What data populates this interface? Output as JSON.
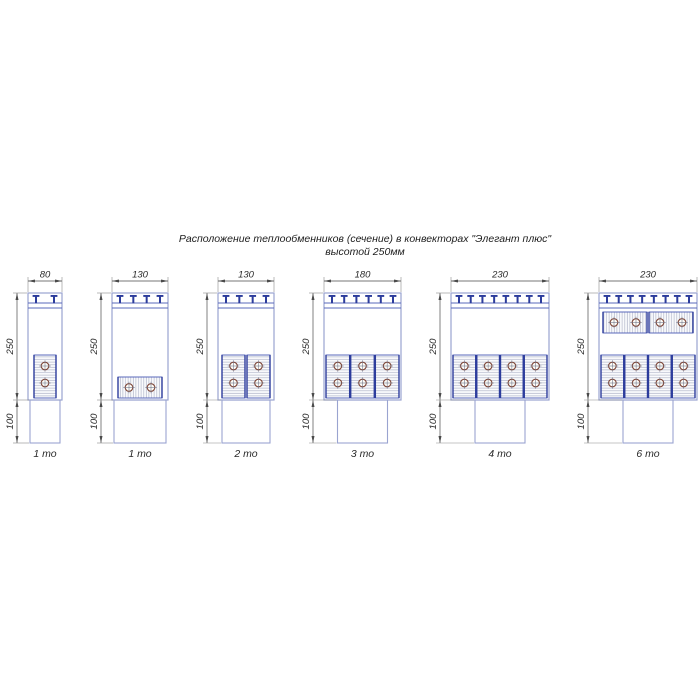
{
  "title": {
    "line1": "Расположение теплообменников (сечение) в конвекторах \"Элегант плюс\"",
    "line2": "высотой 250мм"
  },
  "colors": {
    "outline": "#9aa4d0",
    "line_blue": "#5a68bb",
    "dark_blue": "#2c3c9c",
    "hatch": "#b2b7ca",
    "tube": "#7e4739",
    "tube_cross": "#6b6f85",
    "dim": "#4a4a4a",
    "ext": "#8a8a8a",
    "label": "#1f1f1f"
  },
  "diagrams": [
    {
      "label": "1 то",
      "width_mm": 80,
      "width_label": "80",
      "height_label": "250",
      "base_label": "100",
      "duct_w": 30,
      "brackets": 2,
      "vertical": {
        "count": 1,
        "inset": 6,
        "gap": 2
      },
      "horizontal": null
    },
    {
      "label": "1 то",
      "width_mm": 130,
      "width_label": "130",
      "height_label": "250",
      "base_label": "100",
      "duct_w": 52,
      "brackets": 4,
      "vertical": null,
      "horizontal": {
        "count": 1,
        "inset": 6,
        "y1": 377,
        "y2": 398
      }
    },
    {
      "label": "2 то",
      "width_mm": 130,
      "width_label": "130",
      "height_label": "250",
      "base_label": "100",
      "duct_w": 48,
      "brackets": 4,
      "vertical": {
        "count": 2,
        "inset": 4,
        "gap": 2
      },
      "horizontal": null
    },
    {
      "label": "3 то",
      "width_mm": 180,
      "width_label": "180",
      "height_label": "250",
      "base_label": "100",
      "duct_w": 50,
      "brackets": 6,
      "vertical": {
        "count": 3,
        "inset": 2,
        "gap": 1
      },
      "horizontal": null
    },
    {
      "label": "4 то",
      "width_mm": 230,
      "width_label": "230",
      "height_label": "250",
      "base_label": "100",
      "duct_w": 50,
      "brackets": 8,
      "vertical": {
        "count": 4,
        "inset": 2,
        "gap": 1
      },
      "horizontal": null
    },
    {
      "label": "6 то",
      "width_mm": 230,
      "width_label": "230",
      "height_label": "250",
      "base_label": "100",
      "duct_w": 50,
      "brackets": 8,
      "vertical": {
        "count": 4,
        "inset": 2,
        "gap": 1
      },
      "horizontal": {
        "count": 2,
        "inset": 4,
        "y1": 312,
        "y2": 333
      }
    }
  ]
}
